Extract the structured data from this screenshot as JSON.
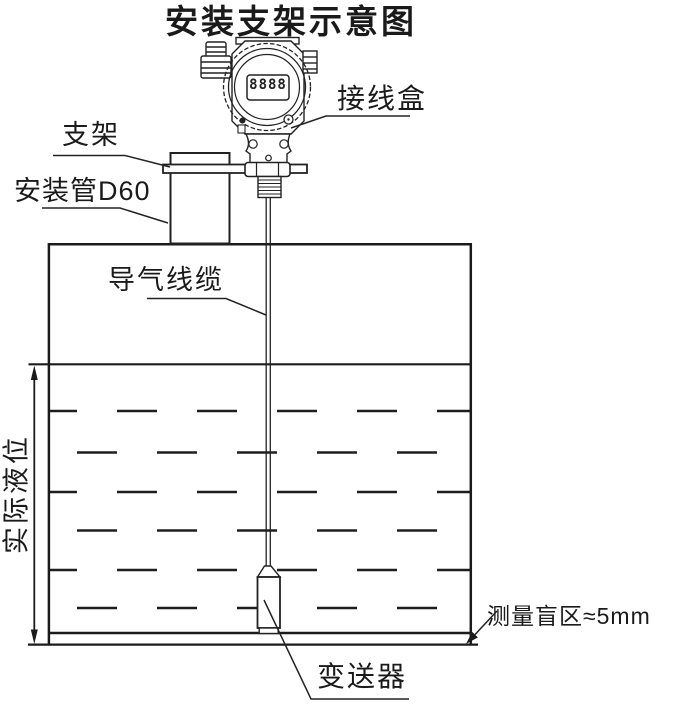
{
  "title": "安装支架示意图",
  "display": {
    "value": "8888"
  },
  "labels": {
    "junction_box": "接线盒",
    "bracket": "支架",
    "mounting_pipe": "安装管D60",
    "air_cable": "导气线缆",
    "actual_level": "实际液位",
    "blind_zone": "测量盲区≈5mm",
    "transmitter": "变送器"
  },
  "colors": {
    "line": "#222222",
    "text": "#1a1a1a",
    "background": "#ffffff"
  }
}
